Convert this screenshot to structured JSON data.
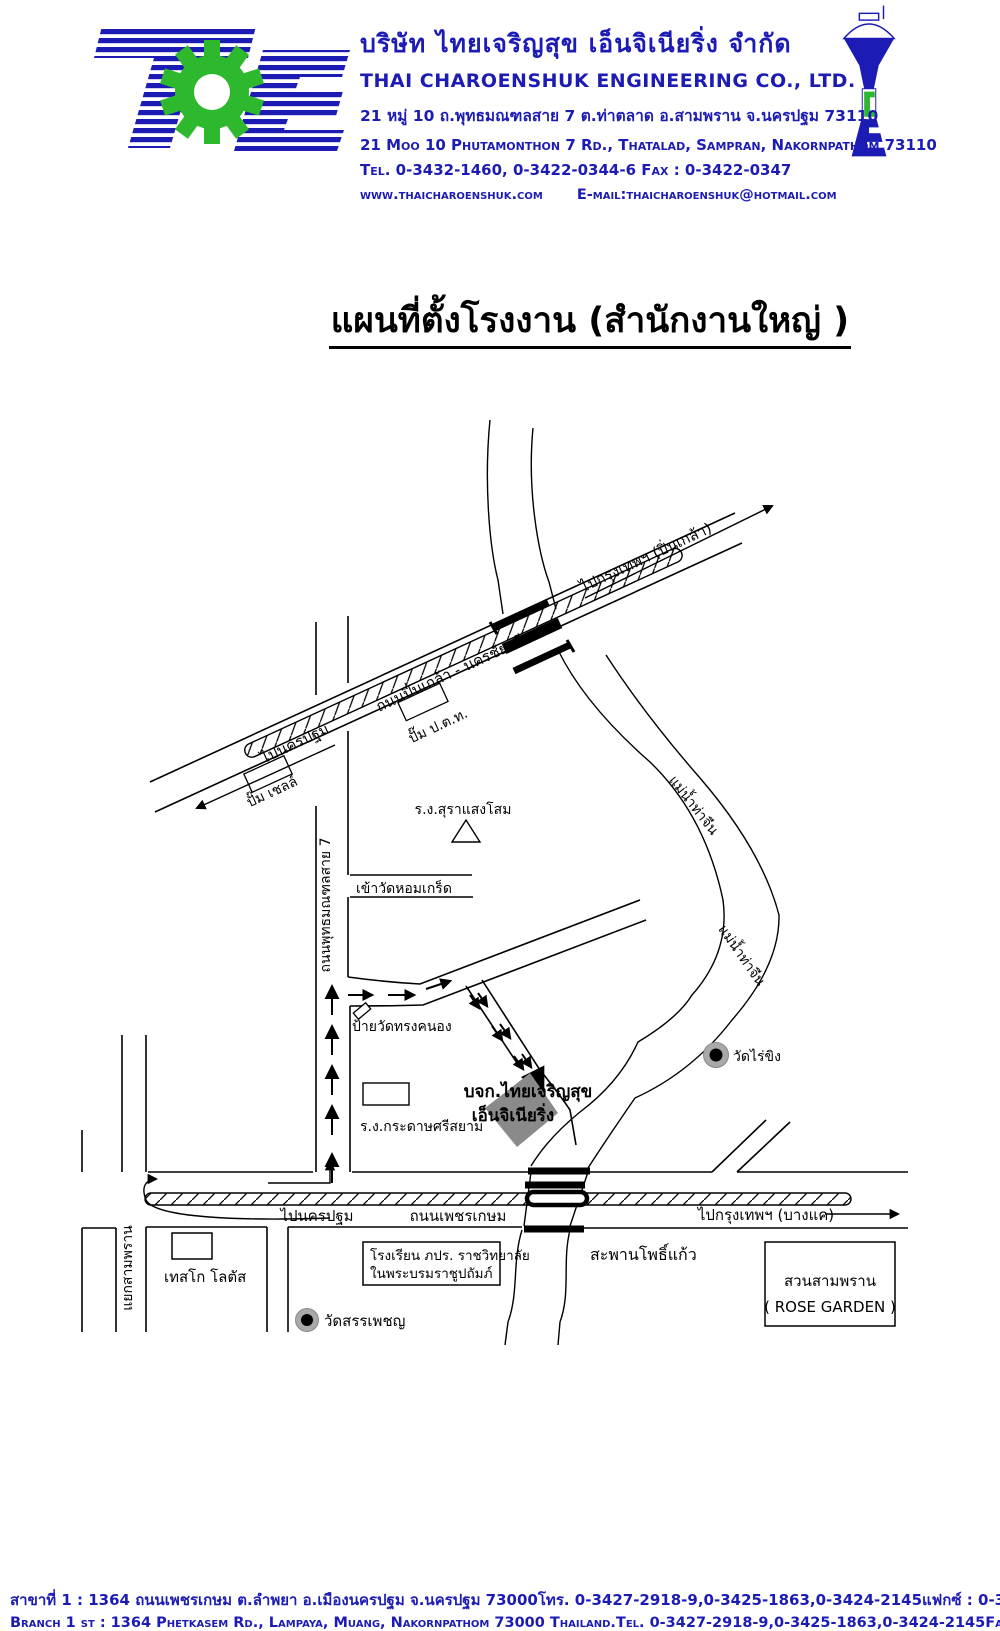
{
  "header": {
    "company_name_th": "บริษัท ไทยเจริญสุข เอ็นจิเนียริ่ง จำกัด",
    "company_name_en": "THAI CHAROENSHUK ENGINEERING CO., LTD.",
    "address_th": "21 หมู่ 10 ถ.พุทธมณฑลสาย 7 ต.ท่าตลาด อ.สามพราน จ.นครปฐม 73110",
    "address_en": "21 Moo 10 Phutamonthon 7 Rd., Thatalad, Sampran, Nakornpathom 73110",
    "tel_fax": "Tel. 0-3432-1460, 0-3422-0344-6   Fax : 0-3422-0347",
    "website": "www.thaicharoenshuk.com",
    "email": "E-mail:thaicharoenshuk@hotmail.com",
    "brand_blue": "#1c1cb4",
    "brand_green": "#2eb82e"
  },
  "title": "แผนที่ตั้งโรงงาน (สำนักงานใหญ่ )",
  "map": {
    "roads": {
      "pinklao_name": "ถนนปิ่นเกล้า - นครชัยศรี",
      "to_bangkok_pinklao": "ไปกรุงเทพฯ (ปิ่นเกล้า)",
      "to_nakornpathom_pinklao": "ไปนครปฐม",
      "sai7_name": "ถนนพุทธมณฑลสาย 7",
      "wat_homkret_entrance": "เข้าวัดหอมเกร็ด",
      "phetkasem_name": "ถนนเพชรเกษม",
      "to_nakornpathom_phetkasem": "ไปนครปฐม",
      "to_bangkok_bangkae": "ไปกรุงเทพฯ (บางแค)",
      "samphran_junction": "แยกสามพราน"
    },
    "places": {
      "ptt_station": "ปั๊ม ป.ต.ท.",
      "shell_station": "ปั๊ม เชลล์",
      "sangsom_factory": "ร.ง.สุราแสงโสม",
      "songkanong_sign": "ป้ายวัดทรงคนอง",
      "srisiam_factory": "ร.ง.กระดาษศรีสยาม",
      "company_line1": "บจก.ไทยเจริญสุข",
      "company_line2": "เอ็นจิเนียริ่ง",
      "wat_raiking": "วัดไร่ขิง",
      "tesco": "เทสโก โลตัส",
      "school_line1": "โรงเรียน ภปร. ราชวิทยาลัย",
      "school_line2": "ในพระบรมราชูปถัมภ์",
      "wat_sanphet": "วัดสรรเพชญ",
      "phokaew_bridge": "สะพานโพธิ์แก้ว",
      "rose_garden_line1": "สวนสามพราน",
      "rose_garden_line2": "( ROSE GARDEN )"
    },
    "river_name": "แม่น้ำท่าจีน"
  },
  "footer": {
    "th": {
      "address": "สาขาที่ 1  : 1364 ถนนเพชรเกษม ต.ลำพยา อ.เมืองนครปฐม จ.นครปฐม 73000",
      "tel": "โทร. 0-3427-2918-9,0-3425-1863,0-3424-2145",
      "fax": "แฟกซ์ : 0-3427-2919"
    },
    "en": {
      "address": "Branch 1 st : 1364 Phetkasem Rd., Lampaya, Muang, Nakornpathom 73000 Thailand.",
      "tel": "Tel. 0-3427-2918-9,0-3425-1863,0-3424-2145",
      "fax": "Fax : 0-3427-2919"
    }
  }
}
